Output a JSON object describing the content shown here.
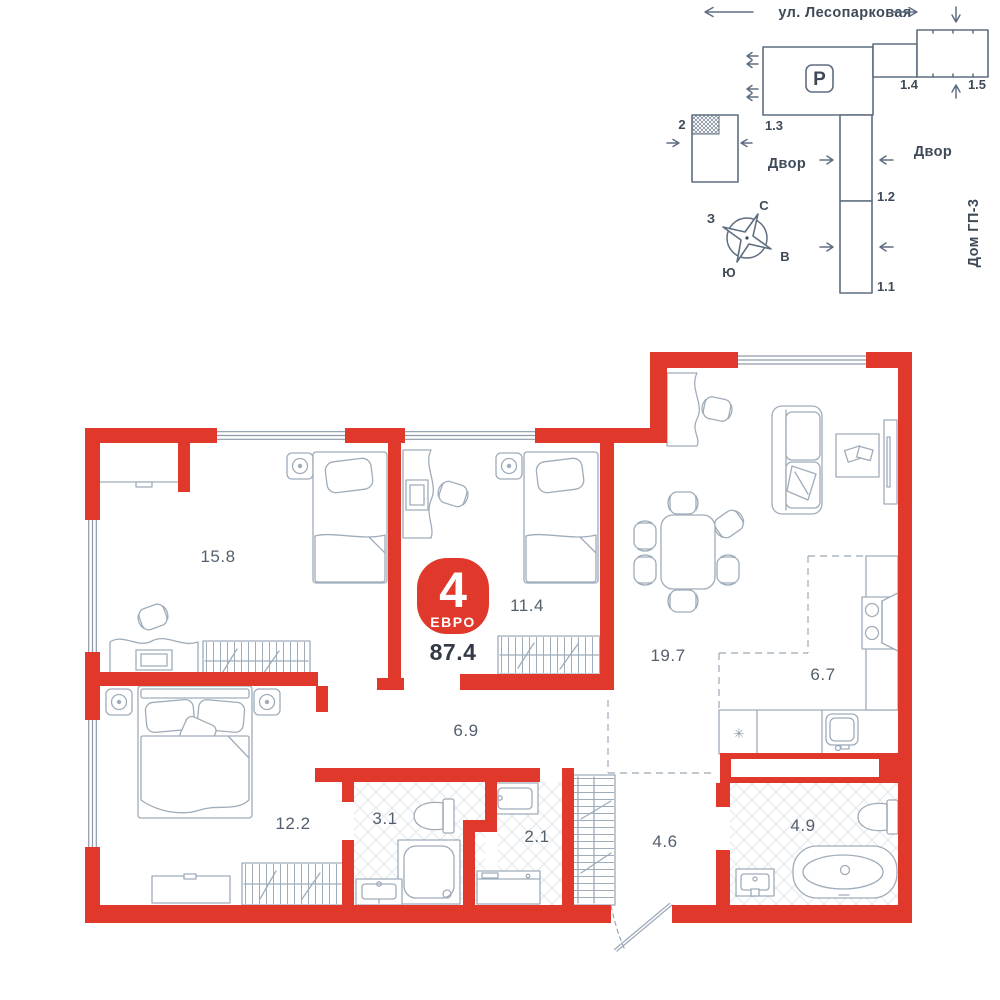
{
  "site_plan": {
    "street_label": "ул. Лесопарковая",
    "parking_label": "P",
    "yard_left": "Двор",
    "yard_right": "Двор",
    "house_right": "Дом ГП-3",
    "building_labels": {
      "b2": "2",
      "b1_3": "1.3",
      "b1_4": "1.4",
      "b1_5": "1.5",
      "b1_2": "1.2",
      "b1_1": "1.1"
    },
    "compass": {
      "north": "С",
      "south": "Ю",
      "west": "З",
      "east": "В"
    }
  },
  "apartment": {
    "rooms_badge": "4",
    "layout_type": "ЕВРО",
    "total_area": "87.4",
    "fridge_symbol": "✳"
  },
  "rooms": {
    "bedroom1": "15.8",
    "bedroom2": "11.4",
    "living": "19.7",
    "kitchen": "6.7",
    "corridor": "6.9",
    "bedroom3": "12.2",
    "bathroom": "3.1",
    "laundry": "2.1",
    "hallway": "4.6",
    "master_bathroom": "4.9"
  },
  "colors": {
    "accent": "#E0382A",
    "furniture_lines": "#9FACBA",
    "site_lines": "#5E6E80",
    "text": "#3E4A58",
    "tiles": "#E3E7EB"
  }
}
